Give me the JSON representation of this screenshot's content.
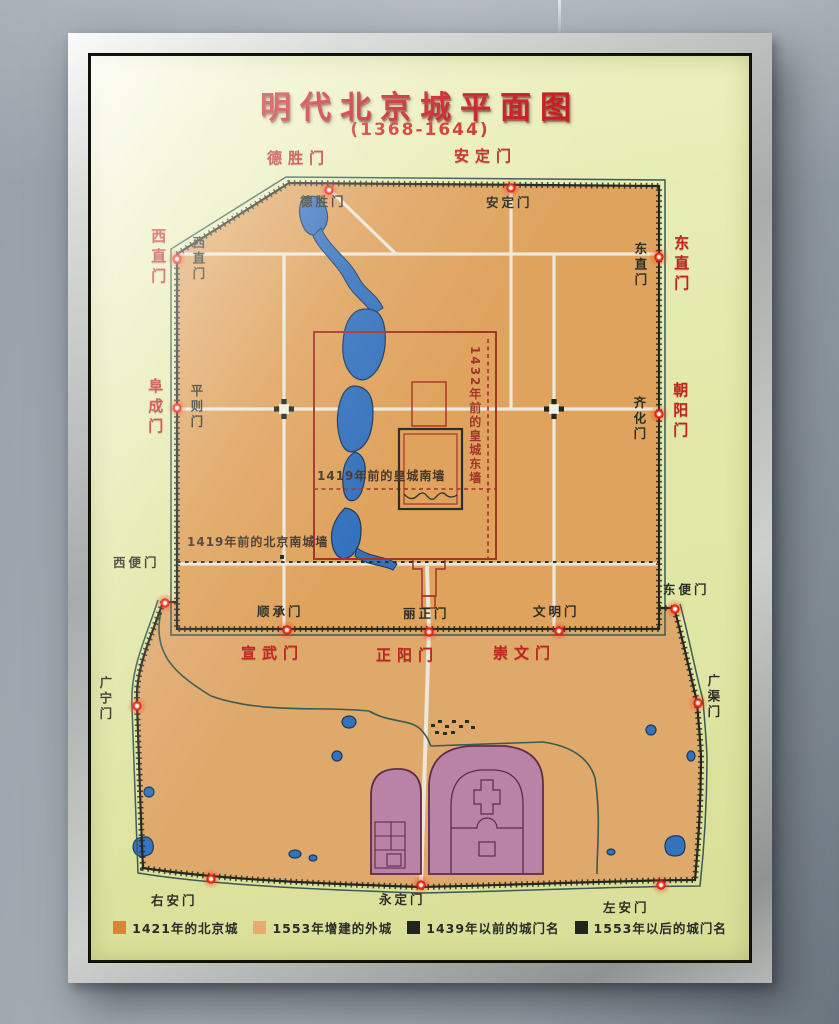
{
  "title": {
    "main": "明代北京城平面图",
    "subtitle": "(1368-1644)"
  },
  "gates_red_renamed": {
    "desheng": "德胜门",
    "anding": "安定门",
    "xizhi": "西直门",
    "fucheng": "阜成门",
    "dongzhi": "东直门",
    "chaoyang": "朝阳门",
    "xuanwu": "宣武门",
    "zhengyang": "正阳门",
    "chongwen": "崇文门"
  },
  "gates_old_pre1439": {
    "desheng": "德胜门",
    "anding": "安定门",
    "xizhi": "西直门",
    "pingze": "平则门",
    "dongzhi": "东直门",
    "qihua": "齐化门",
    "shuncheng": "顺承门",
    "lizheng": "丽正门",
    "wenming": "文明门"
  },
  "gates_outer_post1553": {
    "xibian": "西便门",
    "guangning": "广宁门",
    "dongbian": "东便门",
    "guangqu": "广渠门",
    "youan": "右安门",
    "yongding": "永定门",
    "zuoan": "左安门"
  },
  "annotations": {
    "imperial_east_wall": "1432年前的皇城东墙",
    "imperial_south_wall": "1419年前的皇城南墙",
    "beijing_south_wall": "1419年前的北京南城墙"
  },
  "legend": {
    "items": [
      {
        "swatch": "#d4873b",
        "label": "1421年的北京城"
      },
      {
        "swatch": "#e7aa70",
        "label": "1553年增建的外城"
      },
      {
        "swatch": "#23261f",
        "label": "1439年以前的城门名"
      },
      {
        "swatch": "#23261f",
        "label": "1553年以后的城门名"
      }
    ]
  },
  "colors": {
    "panel": "#e4e9ac",
    "inner_city": "#dfa35e",
    "outer_city": "#e0a96c",
    "water": "#3572bd",
    "wall": "#23281f",
    "moat": "#3a5a52",
    "road": "#ece8da",
    "imperial_wall": "#a63328",
    "temple_fill": "#b983a8",
    "gate_text_red": "#bf2420",
    "gate_text_dark": "#2c2f26",
    "led": "#ff2a1a"
  }
}
